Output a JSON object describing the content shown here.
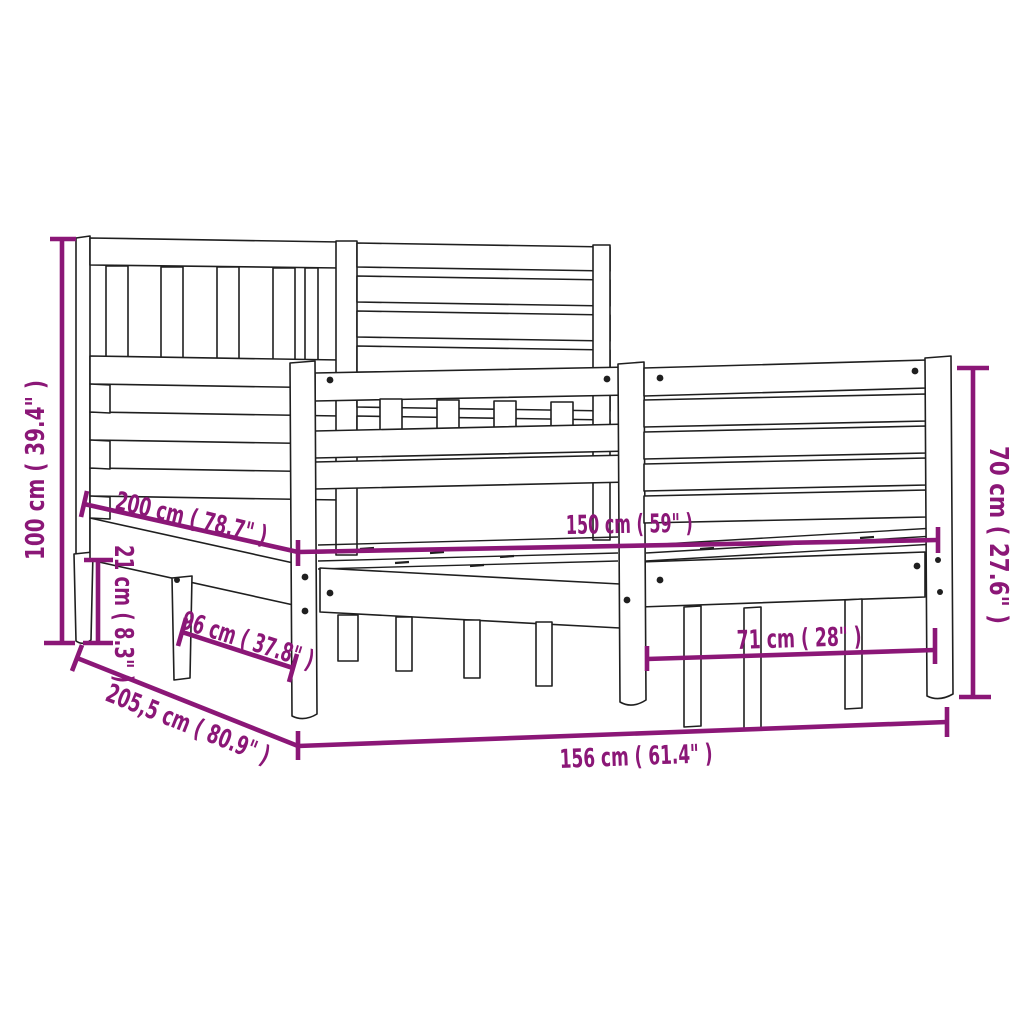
{
  "colors": {
    "dimension": "#8B1777",
    "ink": "#1f1f1f",
    "background": "#ffffff"
  },
  "dimensions": [
    {
      "id": "headboard-height",
      "cm": "100",
      "inches": "39.4",
      "label": "100 cm ( 39.4\" )"
    },
    {
      "id": "bed-length",
      "cm": "200",
      "inches": "78.7",
      "label": "200 cm ( 78.7\" )"
    },
    {
      "id": "rail-height",
      "cm": "21",
      "inches": "8.3",
      "label": "21 cm ( 8.3\" )"
    },
    {
      "id": "side-depth",
      "cm": "96",
      "inches": "37.8",
      "label": "96 cm ( 37.8\" )"
    },
    {
      "id": "total-length",
      "cm": "205,5",
      "inches": "80.9",
      "label": "205,5 cm ( 80.9\" )"
    },
    {
      "id": "total-width",
      "cm": "156",
      "inches": "61.4",
      "label": "156 cm ( 61.4\" )"
    },
    {
      "id": "inner-width",
      "cm": "150",
      "inches": "59",
      "label": "150 cm ( 59\" )"
    },
    {
      "id": "foot-inner-width",
      "cm": "71",
      "inches": "28",
      "label": "71 cm ( 28\" )"
    },
    {
      "id": "footboard-height",
      "cm": "70",
      "inches": "27.6",
      "label": "70 cm ( 27.6\" )"
    }
  ]
}
